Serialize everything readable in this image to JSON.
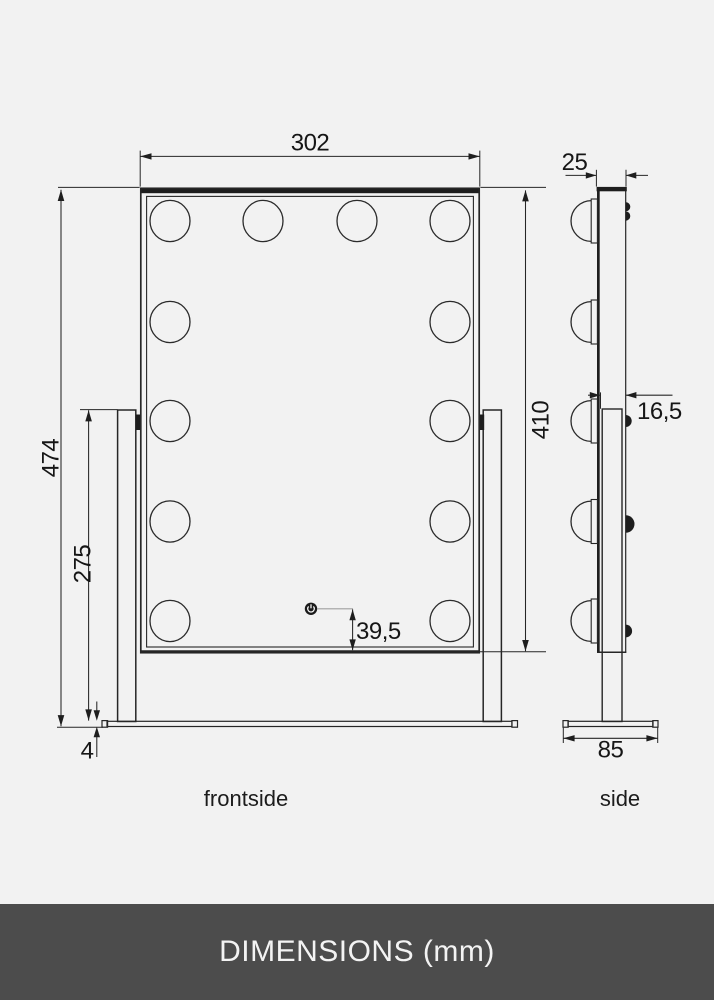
{
  "colors": {
    "background": "#f2f2f2",
    "line": "#262626",
    "footer_bg": "#4c4c4c",
    "footer_text": "#f3f3f3"
  },
  "front_view": {
    "caption": "frontside",
    "bulb_count": 12,
    "dims": {
      "width": "302",
      "overall_height": "474",
      "stand_height": "275",
      "base_thickness": "4",
      "mirror_height": "410",
      "switch_offset": "39,5"
    }
  },
  "side_view": {
    "caption": "side",
    "bulb_count": 5,
    "dims": {
      "depth": "25",
      "bracket_offset": "16,5",
      "base_depth": "85"
    }
  },
  "icons": {
    "power_switch": "power-icon"
  },
  "footer": {
    "label": "DIMENSIONS (mm)"
  }
}
